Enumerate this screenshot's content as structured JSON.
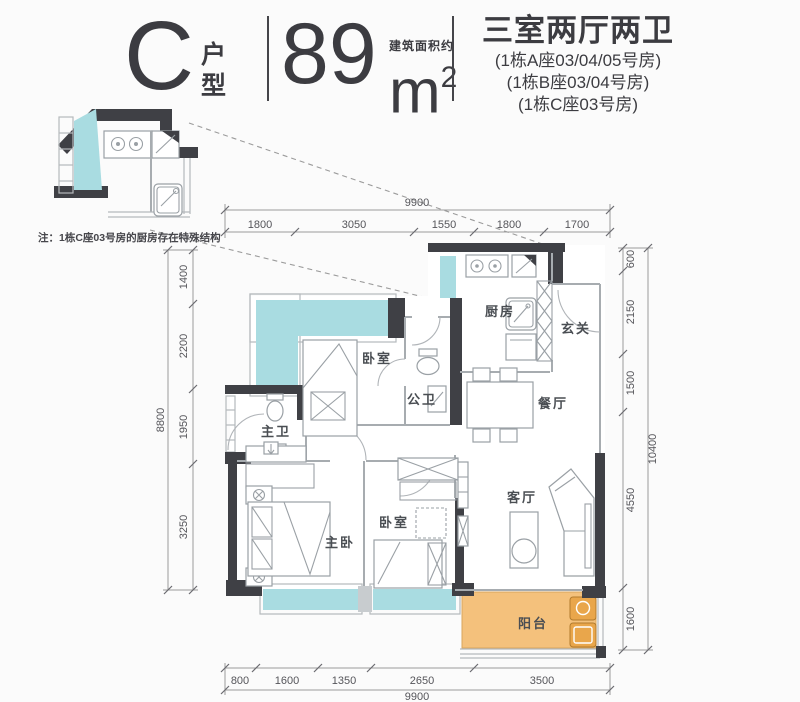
{
  "header": {
    "unit_letter": "C",
    "unit_type": [
      "户",
      "型"
    ],
    "area_value": "89",
    "area_prefix": "建筑面积约",
    "area_unit_base": "m",
    "area_unit_sup": "2",
    "rooms_title": "三室两厅两卫",
    "room_numbers": [
      "(1栋A座03/04/05号房)",
      "(1栋B座03/04号房)",
      "(1栋C座03号房)"
    ]
  },
  "inset": {
    "note": "注：1栋C座03号房的厨房存在特殊结构"
  },
  "rooms": {
    "kitchen": "厨房",
    "entry": "玄关",
    "dining": "餐厅",
    "bath2": "公卫",
    "bedroom_top": "卧室",
    "bath1": "主卫",
    "master": "主卧",
    "bedroom2": "卧室",
    "living": "客厅",
    "balcony": "阳台"
  },
  "dimensions": {
    "top": {
      "total": "9900",
      "segments": [
        "1800",
        "3050",
        "1550",
        "1800",
        "1700"
      ]
    },
    "bottom": {
      "total": "9900",
      "segments": [
        "800",
        "1600",
        "1350",
        "2650",
        "3500"
      ]
    },
    "left": {
      "total": "8800",
      "segments": [
        "1400",
        "2200",
        "1950",
        "3250"
      ]
    },
    "right": {
      "total": "10400",
      "segments": [
        "600",
        "2150",
        "1500",
        "4550",
        "1600"
      ]
    }
  },
  "colors": {
    "wall": "#3F4045",
    "window": "#A9DCE1",
    "balcony": "#F4C17C",
    "washer": "#E9A64B"
  }
}
